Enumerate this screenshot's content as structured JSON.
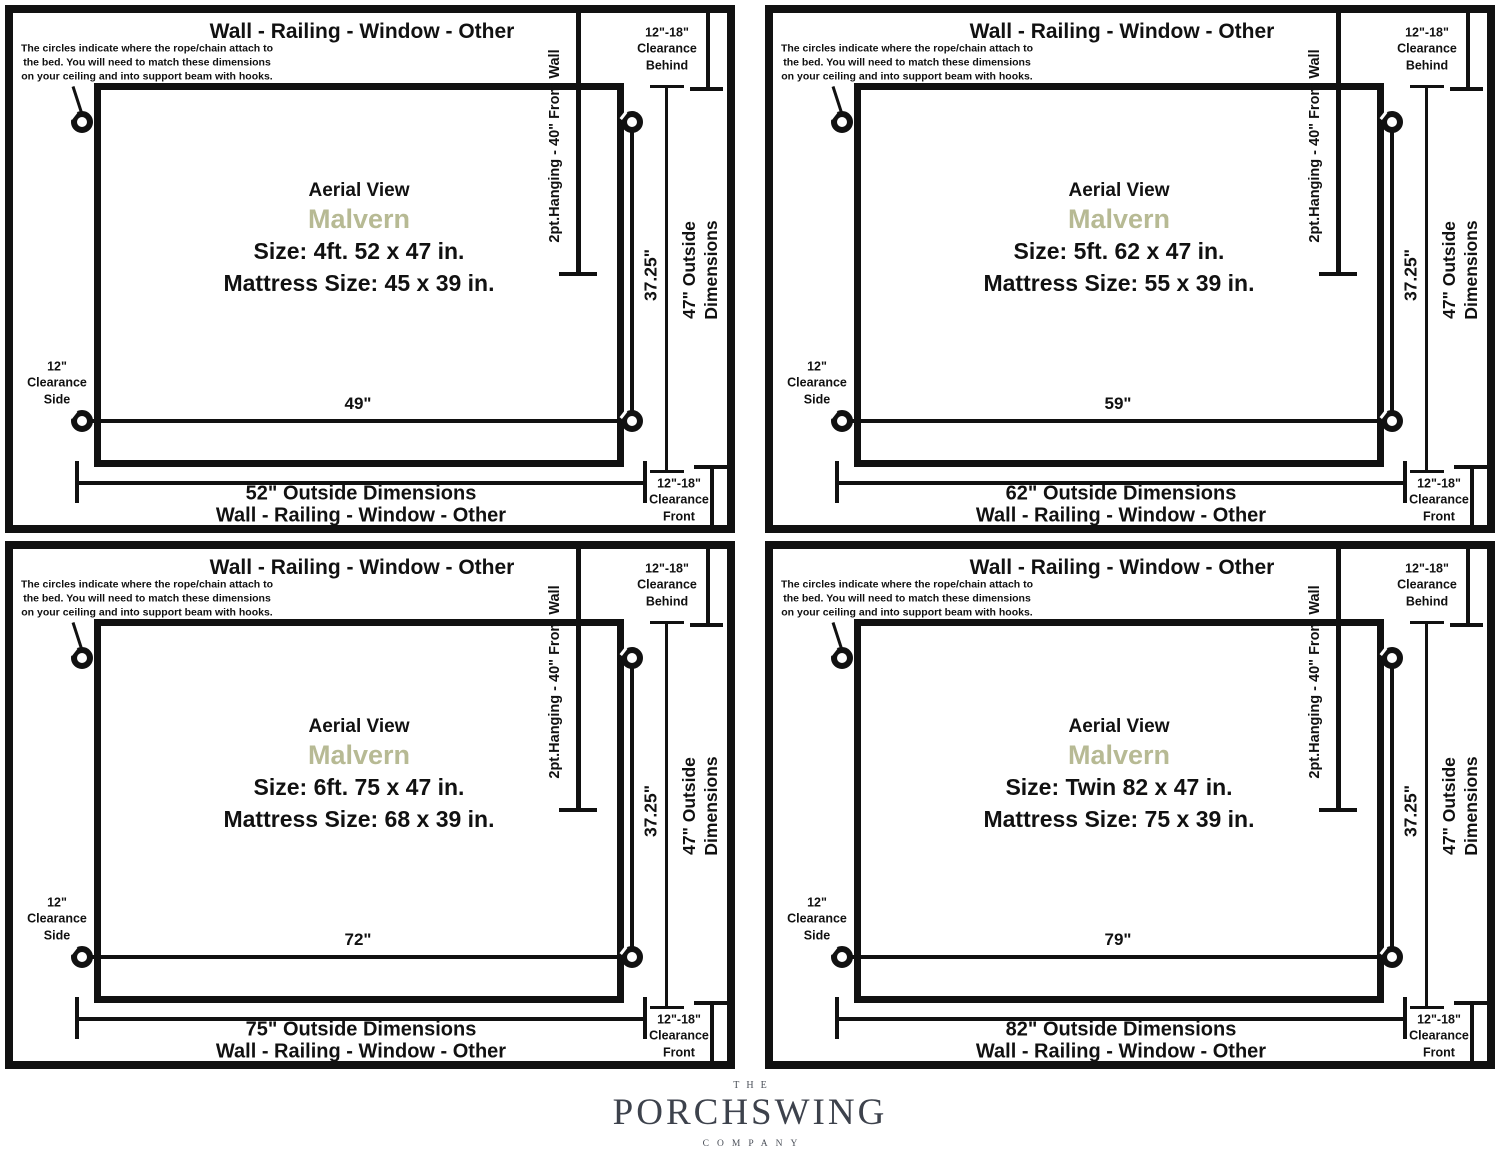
{
  "shared": {
    "wall_label": "Wall - Railing - Window - Other",
    "note": "The circles indicate where the rope/chain attach to\nthe bed. You will need to match these dimensions\non your ceiling and into support beam with hooks.",
    "aerial_view": "Aerial View",
    "model_name": "Malvern",
    "model_color": "#b7ba94",
    "line_color": "#111111",
    "hanging_label": "2pt.Hanging - 40\" From Wall",
    "inner_depth": "37.25\"",
    "outer_depth": "47\" Outside\nDimensions",
    "clearance_behind": "12\"-18\"\nClearance\nBehind",
    "clearance_side": "12\"\nClearance\nSide",
    "clearance_front": "12\"-18\"\nClearance\nFront",
    "ring_icon": "rope-chain-attachment-ring"
  },
  "panels": [
    {
      "name": "4ft",
      "size_label": "Size: 4ft. 52 x 47 in.",
      "mattress_label": "Mattress Size: 45 x 39 in.",
      "inner_width": "49\"",
      "outside_width_label": "52\" Outside Dimensions"
    },
    {
      "name": "5ft",
      "size_label": "Size: 5ft. 62 x 47 in.",
      "mattress_label": "Mattress Size: 55 x 39 in.",
      "inner_width": "59\"",
      "outside_width_label": "62\" Outside Dimensions"
    },
    {
      "name": "6ft",
      "size_label": "Size: 6ft. 75 x 47 in.",
      "mattress_label": "Mattress Size: 68 x 39 in.",
      "inner_width": "72\"",
      "outside_width_label": "75\" Outside Dimensions"
    },
    {
      "name": "twin",
      "size_label": "Size: Twin 82 x 47 in.",
      "mattress_label": "Mattress Size: 75 x 39 in.",
      "inner_width": "79\"",
      "outside_width_label": "82\" Outside Dimensions"
    }
  ],
  "logo": {
    "the": "THE",
    "name": "PORCHSWING",
    "company": "COMPANY",
    "color": "#3d424c"
  }
}
